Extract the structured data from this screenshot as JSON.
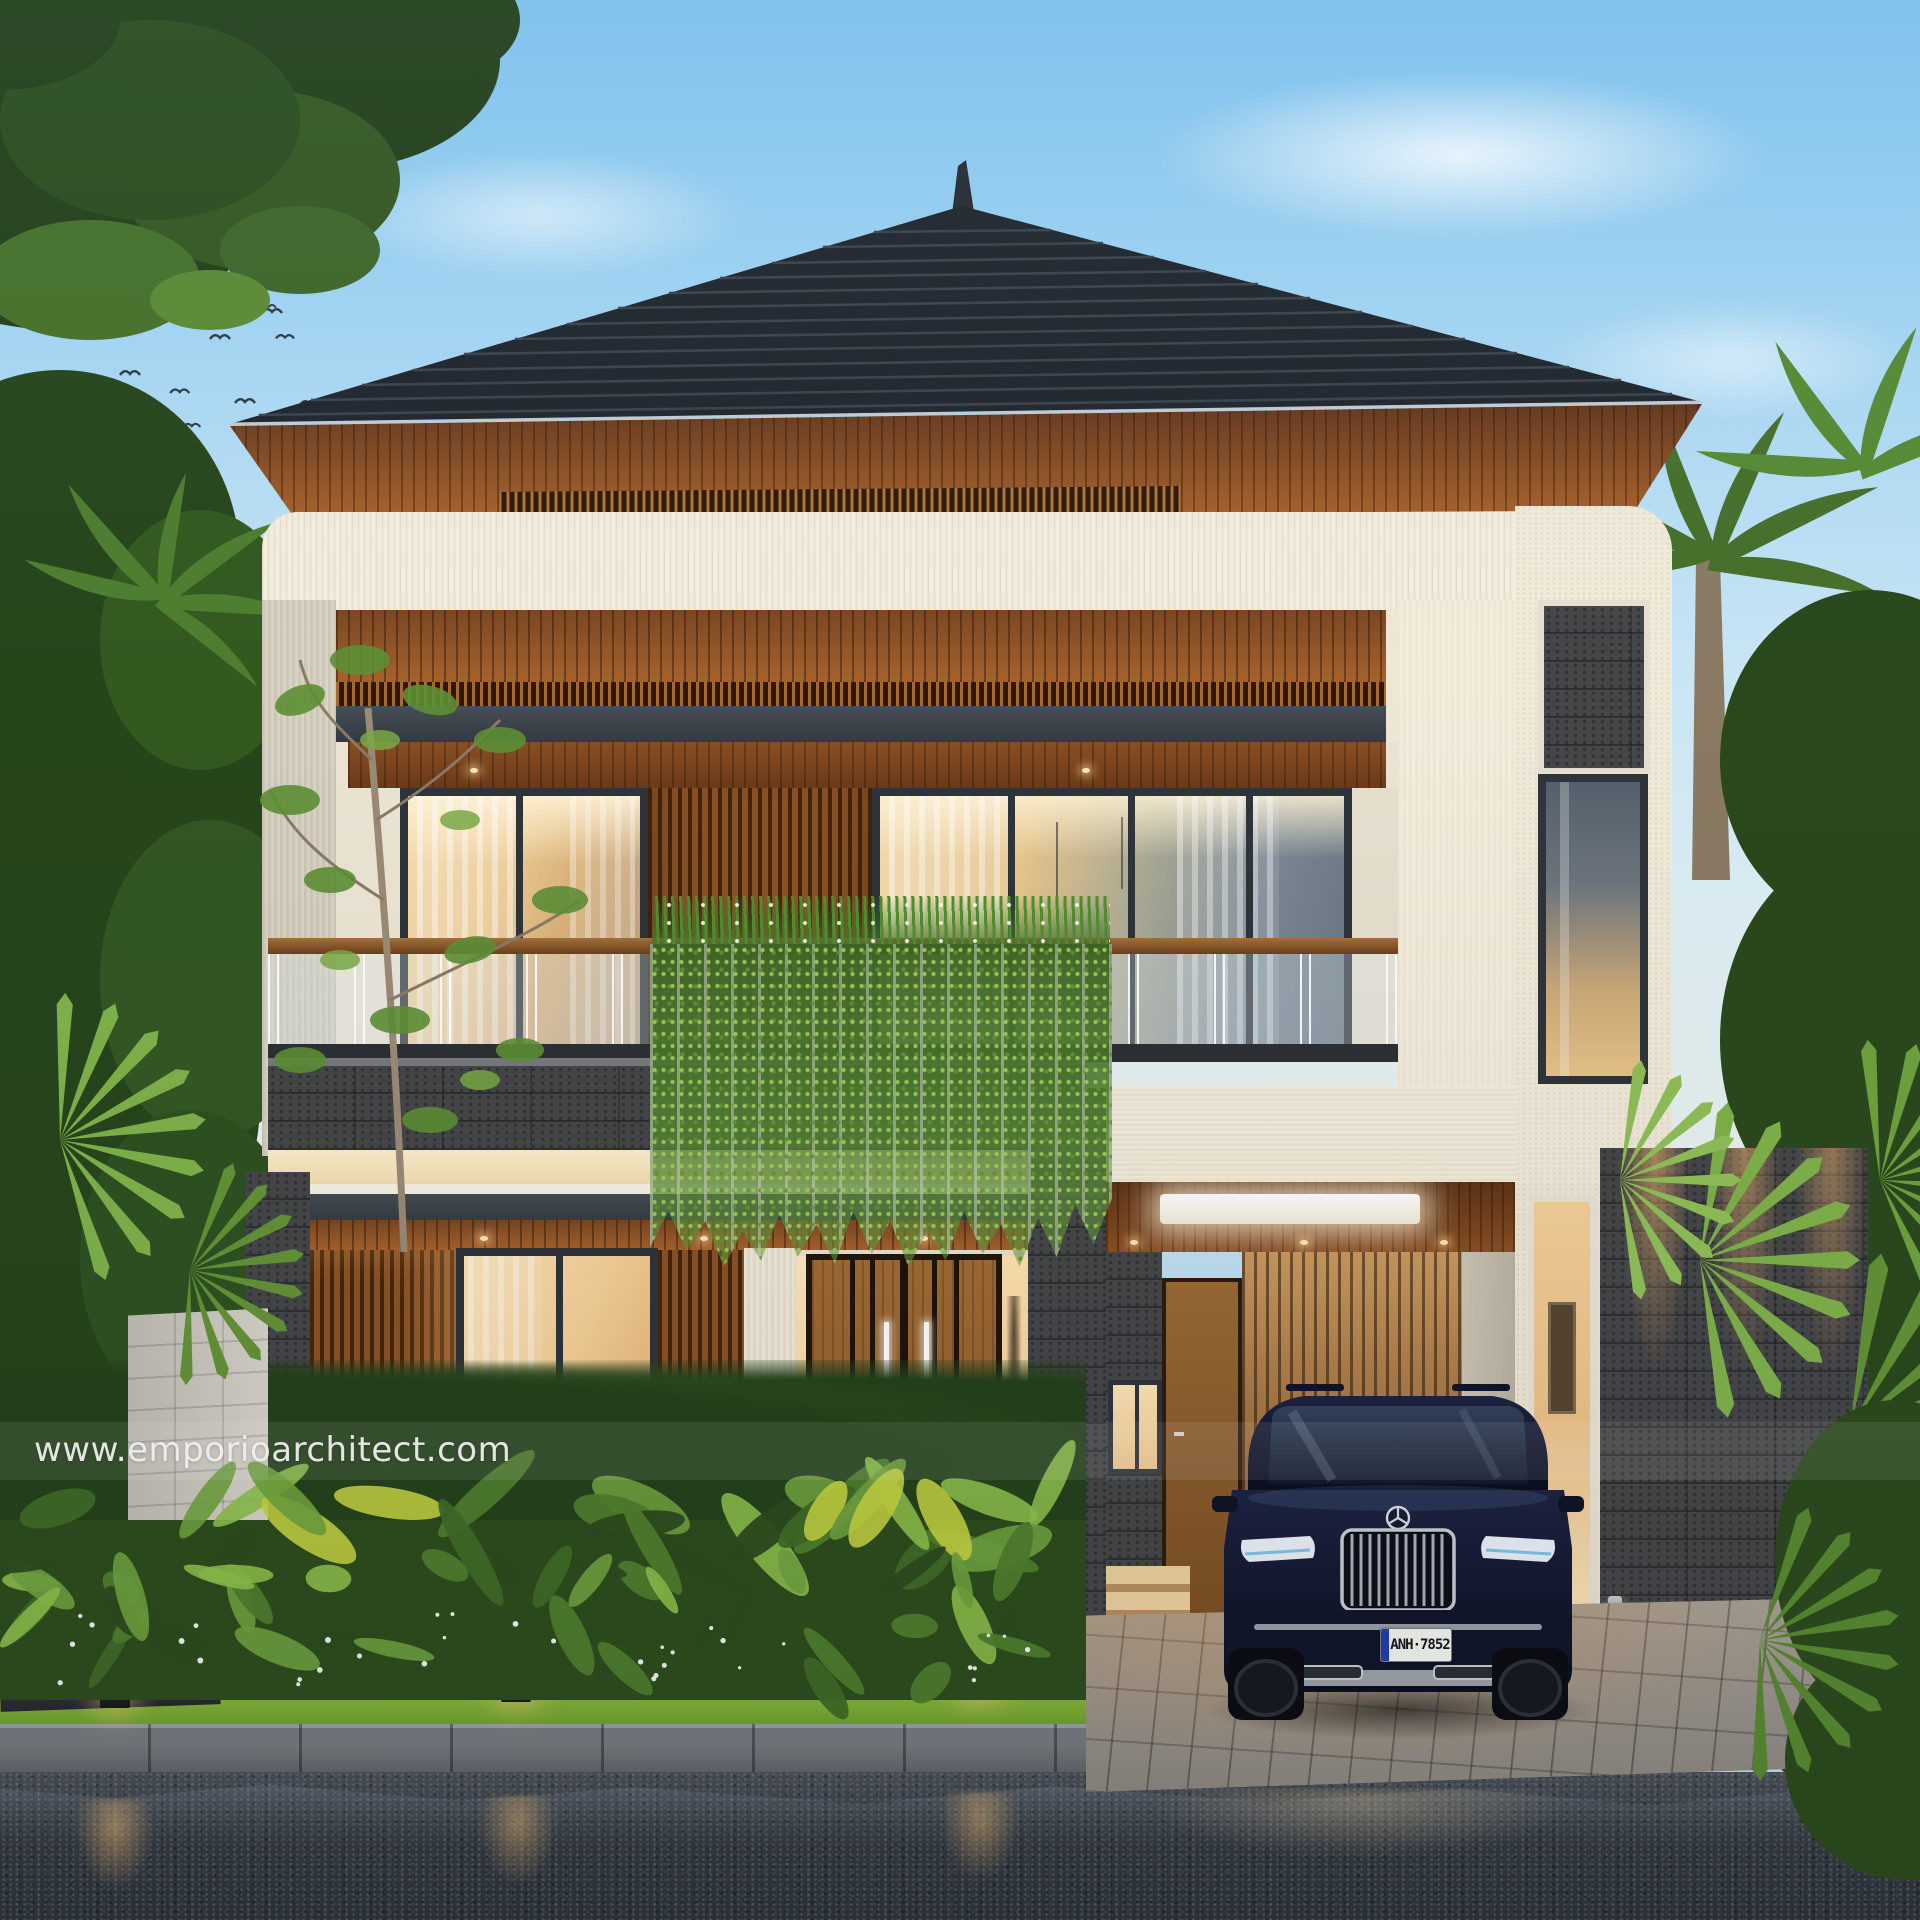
{
  "meta": {
    "description": "Dusk 3D exterior rendering of a modern two-storey tropical house with carport, lush garden, wet street and a luxury SUV parked in front",
    "render_style": "architectural visualization"
  },
  "watermark": {
    "url_label": "www.emporioarchitect.com"
  },
  "car": {
    "type": "luxury SUV",
    "emblem": "three-pointed-star",
    "body_color": "#141830",
    "license_plate": {
      "text": "ANH·7852",
      "strip_color": "#1d3fb0",
      "plate_bg": "#f4f6f1",
      "text_color": "#15181c"
    }
  },
  "lighting": {
    "bollard_count": 3,
    "glow_color": "#ffd9a2",
    "carport_light": "white linear ceiling fixture"
  },
  "garden": {
    "flower_color": "#ffffff",
    "plants": [
      "banana leaves",
      "palm trees",
      "hanging vines",
      "lawn strip"
    ]
  },
  "palette": {
    "sky_top": "#85c6ee",
    "sky_low": "#e9f2ee",
    "roof": "#20252b",
    "roof_ridge": "#3a424b",
    "wood_dark": "#5e3315",
    "wood_mid": "#9c5d28",
    "wood_light": "#c07a36",
    "wall_cream": "#f1e9d8",
    "wall_shadow": "#d6d0c1",
    "beam_gray": "#3a4047",
    "stone": "#454648",
    "glass_warm": "#f4cf97",
    "leaf_dark": "#2c4a1c",
    "leaf_mid": "#4f7d2c",
    "leaf_light": "#8cbf4a",
    "leaf_yellow": "#c3d13f",
    "lawn": "#7fae33",
    "road": "#3a3f45",
    "curb": "#6e7377",
    "chrome": "#cdd3d9"
  }
}
